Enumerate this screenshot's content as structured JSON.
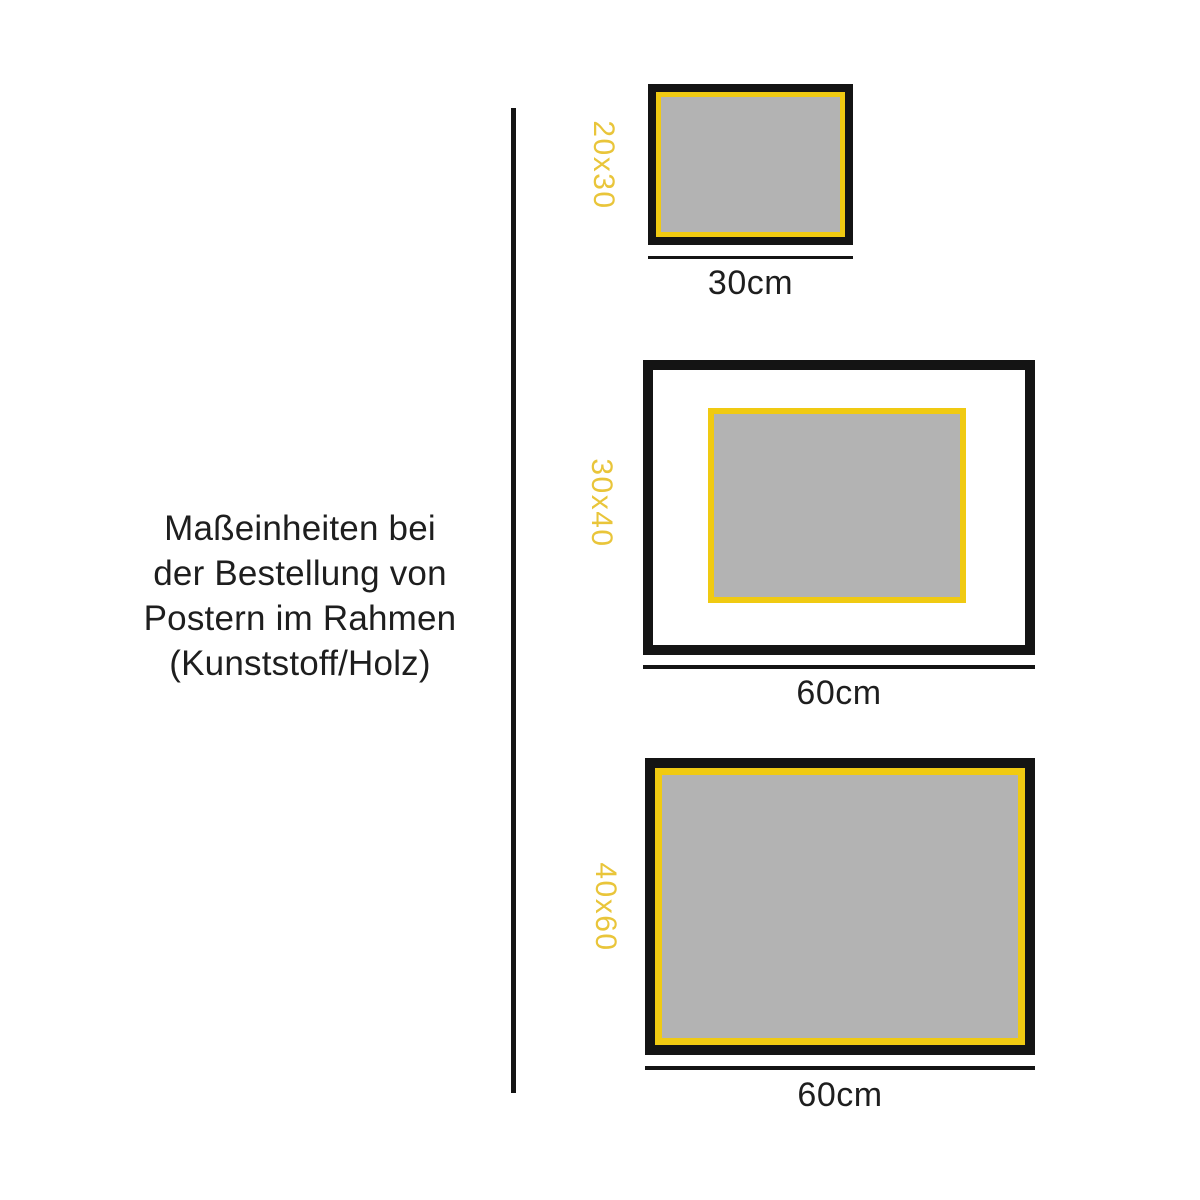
{
  "title": {
    "lines": [
      "Maßeinheiten bei",
      "der Bestellung von",
      "Postern im Rahmen",
      "(Kunststoff/Holz)"
    ]
  },
  "frames": [
    {
      "size_label": "20x30",
      "width_label": "30cm",
      "style": "poster fills frame"
    },
    {
      "size_label": "30x40",
      "width_label": "60cm",
      "style": "poster with white mat"
    },
    {
      "size_label": "40x60",
      "width_label": "60cm",
      "style": "poster fills frame"
    }
  ],
  "colors": {
    "frame_black": "#141414",
    "poster_gray": "#B3B3B3",
    "accent_yellow": "#F0CA12",
    "label_yellow": "#E9C53A",
    "text_color": "#1E1E1E"
  }
}
